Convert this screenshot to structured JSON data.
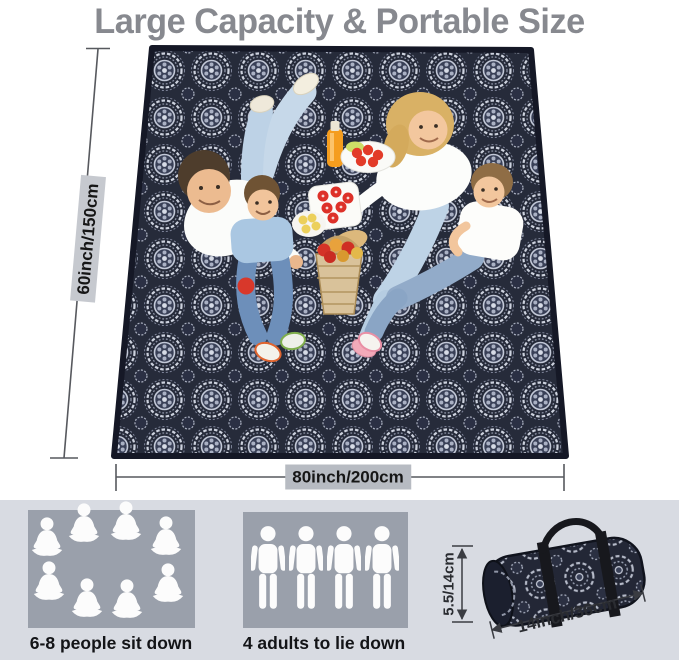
{
  "title": "Large Capacity & Portable Size",
  "blanket": {
    "height_label": "60inch/150cm",
    "width_label": "80inch/200cm"
  },
  "features": {
    "sit": {
      "label": "6-8 people sit down",
      "icon": "sitting-person-icon",
      "icon_count": 8
    },
    "lie": {
      "label": "4 adults to lie down",
      "icon": "standing-person-icon",
      "icon_count": 4
    },
    "bag": {
      "height_label": "5.5/14cm",
      "length_label": "14inch/36cm"
    }
  },
  "colors": {
    "title_text": "#87898f",
    "blanket_base": "#262b3a",
    "blanket_pattern": "#ccd1dd",
    "band_background": "#d8dbe2",
    "panel_background": "#9aa0ab",
    "height_label_background": "#c6c9cf",
    "width_label_background": "#b7bbc2",
    "dimension_line": "#57595e",
    "icon_fill": "#fcfcfc"
  }
}
